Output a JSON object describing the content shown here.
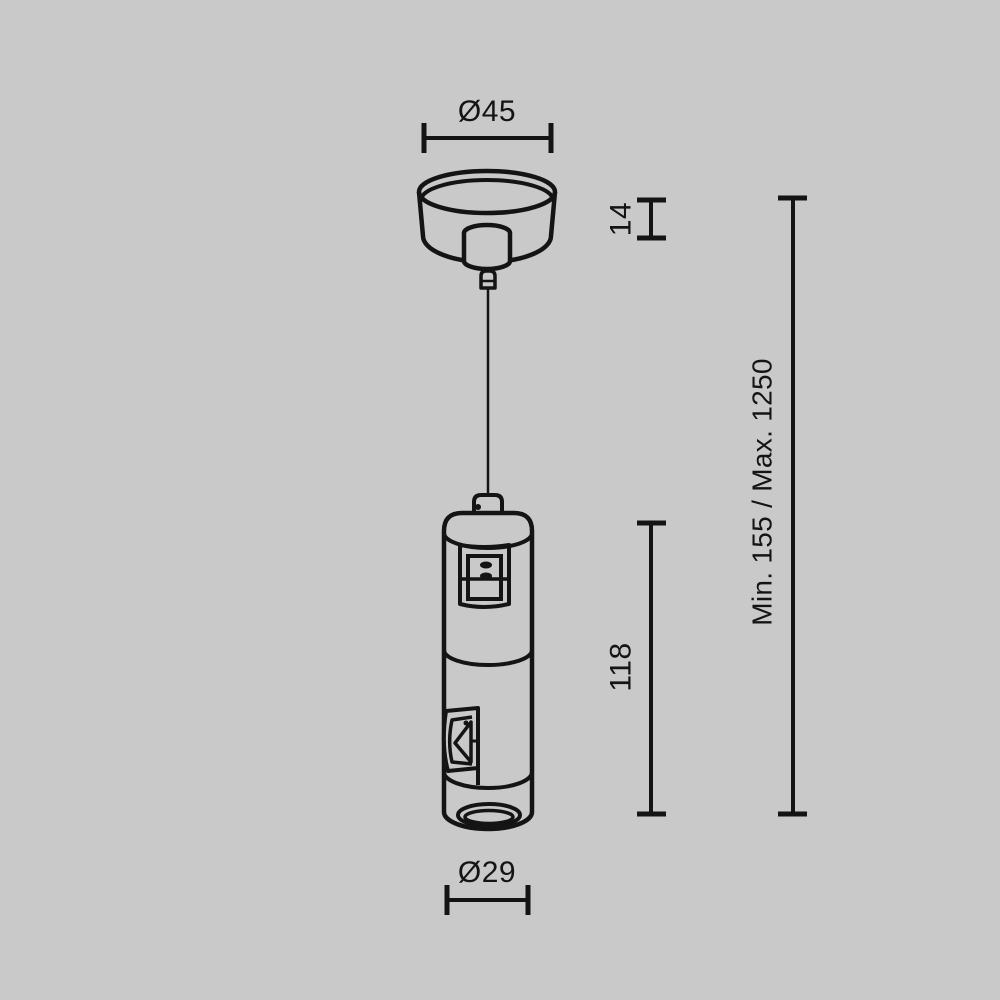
{
  "diagram": {
    "background_color": "#c9c9c9",
    "line_color": "#141414",
    "labels": {
      "canopy_diameter": "Ø45",
      "canopy_height": "14",
      "suspension_range": "Min. 155 / Max. 1250",
      "body_height": "118",
      "body_diameter": "Ø29"
    }
  }
}
